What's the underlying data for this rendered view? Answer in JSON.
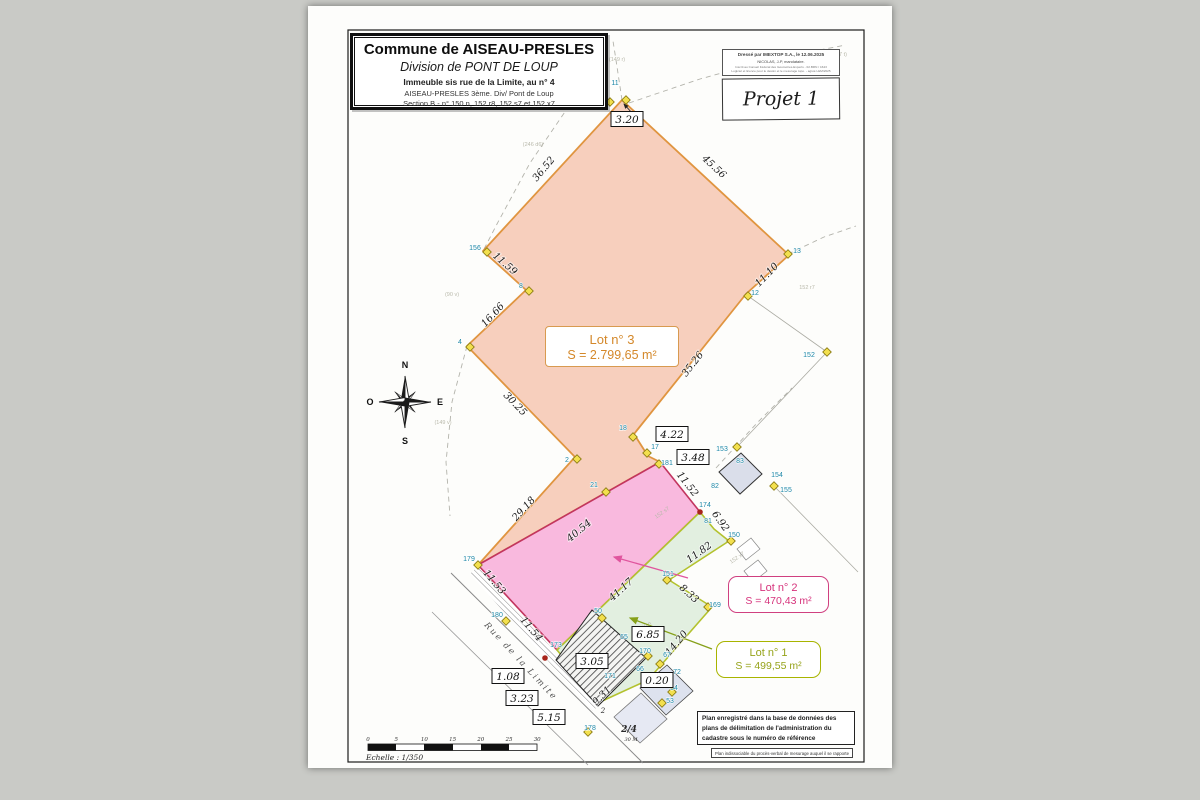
{
  "document": {
    "title_block": {
      "line1": "Commune de AISEAU-PRESLES",
      "line2": "Division de PONT DE LOUP",
      "line3": "Immeuble sis rue de la Limite, au n° 4",
      "line4": "AISEAU-PRESLES   3ème. Div/   Pont de Loup",
      "line5": "Section B  -  n° 150 n, 152 r8, 152 s7 et 152 x7"
    },
    "stamp": {
      "line1": "Dressé par IMEXTOP S.A., le 12.06.2025",
      "line2": "NICOLAS, J-P, mandataire.",
      "line3": "Inscrit au Conseil Fédéral des Géomètres-Experts - 02.BRN / 1643",
      "line4": "Logiciel et licence pour le dessin et le mesurage topo. - agréé LEM/2025",
      "project": "Projet 1"
    },
    "compass": {
      "n": "N",
      "e": "E",
      "s": "S",
      "o": "O"
    },
    "lots": {
      "lot3": {
        "name": "Lot n° 3",
        "area": "S = 2.799,65 m²",
        "text_color": "#d4882a",
        "fill": "#f7cfbd",
        "border": "#e09540"
      },
      "lot2": {
        "name": "Lot n° 2",
        "area": "S = 470,43 m²",
        "text_color": "#d6337c",
        "fill": "#f9b9de",
        "border": "#c2355f"
      },
      "lot1": {
        "name": "Lot n° 1",
        "area": "S = 499,55 m²",
        "text_color": "#96a31a",
        "fill": "#e2efe0",
        "border": "#b3c22e"
      }
    },
    "street_label": "Rue de la Limite",
    "scale": {
      "label": "Echelle : 1/350",
      "ticks": [
        "0",
        "5",
        "10",
        "15",
        "20",
        "25",
        "30"
      ]
    },
    "notes": {
      "registration": "Plan enregistré dans la base de données des plans de délimitation de l'administration du cadastre sous le numéro de référence",
      "annex": "Plan indissociable du procès-verbal de mesurage auquel il se rapporte"
    },
    "boxed_measurements": [
      {
        "t": "3.20",
        "x": 627,
        "y": 119
      },
      {
        "t": "4.22",
        "x": 672,
        "y": 434
      },
      {
        "t": "3.48",
        "x": 693,
        "y": 457
      },
      {
        "t": "6.85",
        "x": 648,
        "y": 634
      },
      {
        "t": "3.05",
        "x": 592,
        "y": 661
      },
      {
        "t": "0.20",
        "x": 657,
        "y": 680
      },
      {
        "t": "1.08",
        "x": 508,
        "y": 676
      },
      {
        "t": "3.23",
        "x": 522,
        "y": 698
      },
      {
        "t": "5.15",
        "x": 549,
        "y": 717
      }
    ],
    "edge_measurements": [
      {
        "t": "36.52",
        "x": 546,
        "y": 171,
        "r": -50
      },
      {
        "t": "45.56",
        "x": 712,
        "y": 169,
        "r": 43
      },
      {
        "t": "11.59",
        "x": 503,
        "y": 266,
        "r": 41
      },
      {
        "t": "16.66",
        "x": 495,
        "y": 317,
        "r": -47
      },
      {
        "t": "30.25",
        "x": 513,
        "y": 406,
        "r": 46
      },
      {
        "t": "29.18",
        "x": 526,
        "y": 511,
        "r": -47
      },
      {
        "t": "11.53",
        "x": 492,
        "y": 584,
        "r": 50
      },
      {
        "t": "11.54",
        "x": 529,
        "y": 631,
        "r": 50
      },
      {
        "t": "11.10",
        "x": 769,
        "y": 277,
        "r": -46
      },
      {
        "t": "35.26",
        "x": 695,
        "y": 366,
        "r": -52
      },
      {
        "t": "11.52",
        "x": 685,
        "y": 486,
        "r": 52
      },
      {
        "t": "6.92",
        "x": 718,
        "y": 523,
        "r": 55
      },
      {
        "t": "11.82",
        "x": 701,
        "y": 555,
        "r": -36
      },
      {
        "t": "8.33",
        "x": 687,
        "y": 596,
        "r": 42
      },
      {
        "t": "40.54",
        "x": 581,
        "y": 533,
        "r": -40
      },
      {
        "t": "41.17",
        "x": 623,
        "y": 592,
        "r": -42
      },
      {
        "t": "14.20",
        "x": 679,
        "y": 645,
        "r": -50
      },
      {
        "t": "9.31",
        "x": 604,
        "y": 698,
        "r": -45
      }
    ],
    "point_labels": [
      {
        "t": "156",
        "x": 475,
        "y": 250
      },
      {
        "t": "8",
        "x": 521,
        "y": 288
      },
      {
        "t": "4",
        "x": 460,
        "y": 344
      },
      {
        "t": "2",
        "x": 567,
        "y": 462
      },
      {
        "t": "10",
        "x": 600,
        "y": 97
      },
      {
        "t": "11",
        "x": 615,
        "y": 85
      },
      {
        "t": "13",
        "x": 797,
        "y": 253
      },
      {
        "t": "12",
        "x": 755,
        "y": 295
      },
      {
        "t": "152",
        "x": 809,
        "y": 357
      },
      {
        "t": "18",
        "x": 623,
        "y": 430
      },
      {
        "t": "17",
        "x": 655,
        "y": 449
      },
      {
        "t": "181",
        "x": 667,
        "y": 465
      },
      {
        "t": "21",
        "x": 594,
        "y": 487
      },
      {
        "t": "174",
        "x": 705,
        "y": 507
      },
      {
        "t": "82",
        "x": 715,
        "y": 488
      },
      {
        "t": "83",
        "x": 740,
        "y": 463
      },
      {
        "t": "153",
        "x": 722,
        "y": 451
      },
      {
        "t": "154",
        "x": 777,
        "y": 477
      },
      {
        "t": "155",
        "x": 786,
        "y": 492
      },
      {
        "t": "81",
        "x": 708,
        "y": 523
      },
      {
        "t": "150",
        "x": 734,
        "y": 537
      },
      {
        "t": "151",
        "x": 668,
        "y": 576
      },
      {
        "t": "169",
        "x": 715,
        "y": 607
      },
      {
        "t": "50",
        "x": 598,
        "y": 613
      },
      {
        "t": "65",
        "x": 624,
        "y": 639
      },
      {
        "t": "170",
        "x": 645,
        "y": 653
      },
      {
        "t": "67",
        "x": 667,
        "y": 657
      },
      {
        "t": "66",
        "x": 640,
        "y": 671
      },
      {
        "t": "171",
        "x": 610,
        "y": 678
      },
      {
        "t": "72",
        "x": 677,
        "y": 674
      },
      {
        "t": "54",
        "x": 674,
        "y": 690
      },
      {
        "t": "53",
        "x": 670,
        "y": 703
      },
      {
        "t": "180",
        "x": 497,
        "y": 617
      },
      {
        "t": "173",
        "x": 556,
        "y": 647
      },
      {
        "t": "178",
        "x": 590,
        "y": 730
      },
      {
        "t": "179",
        "x": 469,
        "y": 561
      }
    ],
    "point_markers": [
      {
        "x": 610,
        "y": 102,
        "k": "d"
      },
      {
        "x": 626,
        "y": 100,
        "k": "d"
      },
      {
        "x": 487,
        "y": 252,
        "k": "d"
      },
      {
        "x": 529,
        "y": 291,
        "k": "d"
      },
      {
        "x": 470,
        "y": 347,
        "k": "d"
      },
      {
        "x": 577,
        "y": 459,
        "k": "d"
      },
      {
        "x": 633,
        "y": 437,
        "k": "d"
      },
      {
        "x": 647,
        "y": 453,
        "k": "d"
      },
      {
        "x": 788,
        "y": 254,
        "k": "d"
      },
      {
        "x": 748,
        "y": 296,
        "k": "d"
      },
      {
        "x": 827,
        "y": 352,
        "k": "d"
      },
      {
        "x": 737,
        "y": 447,
        "k": "d"
      },
      {
        "x": 774,
        "y": 486,
        "k": "d"
      },
      {
        "x": 506,
        "y": 621,
        "k": "d"
      },
      {
        "x": 659,
        "y": 464,
        "k": "d"
      },
      {
        "x": 606,
        "y": 492,
        "k": "d"
      },
      {
        "x": 731,
        "y": 541,
        "k": "d"
      },
      {
        "x": 667,
        "y": 580,
        "k": "d"
      },
      {
        "x": 708,
        "y": 607,
        "k": "d"
      },
      {
        "x": 602,
        "y": 618,
        "k": "d"
      },
      {
        "x": 648,
        "y": 656,
        "k": "d"
      },
      {
        "x": 662,
        "y": 703,
        "k": "d"
      },
      {
        "x": 672,
        "y": 692,
        "k": "d"
      },
      {
        "x": 660,
        "y": 664,
        "k": "d"
      },
      {
        "x": 588,
        "y": 732,
        "k": "d"
      },
      {
        "x": 478,
        "y": 565,
        "k": "d"
      },
      {
        "x": 700,
        "y": 512,
        "k": "r"
      },
      {
        "x": 545,
        "y": 658,
        "k": "r"
      }
    ],
    "faded_labels": [
      {
        "t": "(149 r)",
        "x": 617,
        "y": 61,
        "r": 0
      },
      {
        "t": "(177 t)",
        "x": 839,
        "y": 56,
        "r": 0
      },
      {
        "t": "(246 d6)",
        "x": 533,
        "y": 146,
        "r": 0
      },
      {
        "t": "(90 v)",
        "x": 452,
        "y": 296,
        "r": 0
      },
      {
        "t": "(149 v)",
        "x": 443,
        "y": 424,
        "r": 0
      },
      {
        "t": "152 r7",
        "x": 807,
        "y": 289,
        "r": 0
      },
      {
        "t": "152 s7",
        "x": 663,
        "y": 514,
        "r": -35
      },
      {
        "t": "152 x7",
        "x": 738,
        "y": 559,
        "r": -35
      },
      {
        "t": "150 n",
        "x": 646,
        "y": 628,
        "r": -35
      }
    ],
    "misc_labels": [
      {
        "t": "2/4",
        "x": 629,
        "y": 732,
        "s": 9,
        "i": true,
        "b": true
      },
      {
        "t": "30 M",
        "x": 631,
        "y": 741,
        "s": 5,
        "i": true,
        "b": false
      },
      {
        "t": "2",
        "x": 603,
        "y": 713,
        "s": 7,
        "i": true,
        "b": false
      }
    ]
  }
}
